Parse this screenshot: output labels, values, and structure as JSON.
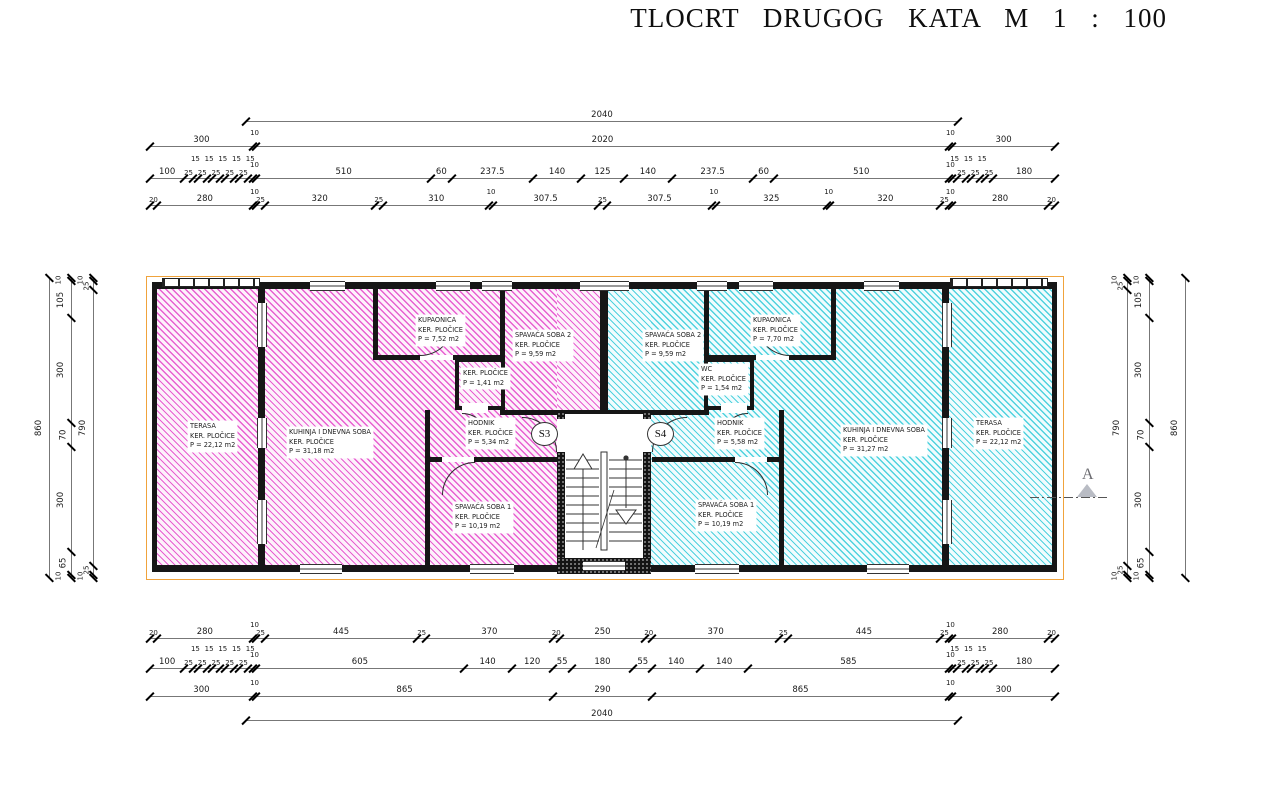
{
  "title": "TLOCRT DRUGOG KATA M 1 : 100",
  "section_marker": {
    "label": "A"
  },
  "stairs": {
    "left_label": "S3",
    "right_label": "S4"
  },
  "colors": {
    "hatch_left": "#e85fd1",
    "hatch_right": "#4fd2de",
    "wall": "#161616",
    "outline": "#f0a33c"
  },
  "apartments": {
    "left": {
      "hatch": "magenta",
      "rooms": [
        {
          "name": "TERASA",
          "finish": "KER. PLOČICE",
          "area": "P = 22,12 m2"
        },
        {
          "name": "KUHINJA I DNEVNA SOBA",
          "finish": "KER. PLOČICE",
          "area": "P = 31,18 m2"
        },
        {
          "name": "KUPAONICA",
          "finish": "KER. PLOČICE",
          "area": "P = 7,52 m2"
        },
        {
          "name": "SPAVAĆA SOBA 2",
          "finish": "KER. PLOČICE",
          "area": "P = 9,59 m2"
        },
        {
          "name": "",
          "finish": "KER. PLOČICE",
          "area": "P = 1,41 m2"
        },
        {
          "name": "HODNIK",
          "finish": "KER. PLOČICE",
          "area": "P = 5,34 m2"
        },
        {
          "name": "SPAVAĆA SOBA 1",
          "finish": "KER. PLOČICE",
          "area": "P = 10,19 m2"
        }
      ]
    },
    "right": {
      "hatch": "cyan",
      "rooms": [
        {
          "name": "SPAVAĆA SOBA 2",
          "finish": "KER. PLOČICE",
          "area": "P = 9,59 m2"
        },
        {
          "name": "KUPAONICA",
          "finish": "KER. PLOČICE",
          "area": "P = 7,70 m2"
        },
        {
          "name": "WC",
          "finish": "KER. PLOČICE",
          "area": "P = 1,54 m2"
        },
        {
          "name": "HODNIK",
          "finish": "KER. PLOČICE",
          "area": "P = 5,58 m2"
        },
        {
          "name": "SPAVAĆA SOBA 1",
          "finish": "KER. PLOČICE",
          "area": "P = 10,19 m2"
        },
        {
          "name": "KUHINJA I DNEVNA SOBA",
          "finish": "KER. PLOČICE",
          "area": "P = 31,27 m2"
        },
        {
          "name": "TERASA",
          "finish": "KER. PLOČICE",
          "area": "P = 22,12 m2"
        }
      ]
    }
  },
  "chains": {
    "t1": [
      "2040"
    ],
    "t2": [
      "300",
      "10",
      "2020",
      "10",
      "300"
    ],
    "t3": [
      "100",
      "25",
      "15",
      "25",
      "15",
      "25",
      "15",
      "25",
      "15",
      "25",
      "15",
      "10",
      "510",
      "60",
      "237.5",
      "140",
      "125",
      "140",
      "237.5",
      "60",
      "510",
      "10",
      "15",
      "25",
      "15",
      "25",
      "15",
      "25",
      "180"
    ],
    "t4": [
      "20",
      "280",
      "10",
      "25",
      "320",
      "25",
      "310",
      "10",
      "307.5",
      "25",
      "307.5",
      "10",
      "325",
      "10",
      "320",
      "25",
      "10",
      "280",
      "20"
    ],
    "b1": [
      "20",
      "280",
      "10",
      "25",
      "445",
      "25",
      "370",
      "20",
      "250",
      "20",
      "370",
      "25",
      "445",
      "25",
      "10",
      "280",
      "20"
    ],
    "b2": [
      "100",
      "25",
      "15",
      "25",
      "15",
      "25",
      "15",
      "25",
      "15",
      "25",
      "15",
      "10",
      "605",
      "140",
      "120",
      "55",
      "180",
      "55",
      "140",
      "140",
      "585",
      "10",
      "15",
      "25",
      "15",
      "25",
      "15",
      "25",
      "180"
    ],
    "b3": [
      "300",
      "10",
      "865",
      "290",
      "865",
      "10",
      "300"
    ],
    "b4": [
      "2040"
    ],
    "vl1": [
      "860"
    ],
    "vl2": [
      "10",
      "105",
      "300",
      "70",
      "300",
      "65",
      "10"
    ],
    "vl3": [
      "10",
      "25",
      "790",
      "25",
      "10"
    ],
    "vr1": [
      "10",
      "25",
      "790",
      "25",
      "10"
    ],
    "vr2": [
      "10",
      "105",
      "300",
      "70",
      "300",
      "65",
      "10"
    ],
    "vr3": [
      "860"
    ]
  }
}
